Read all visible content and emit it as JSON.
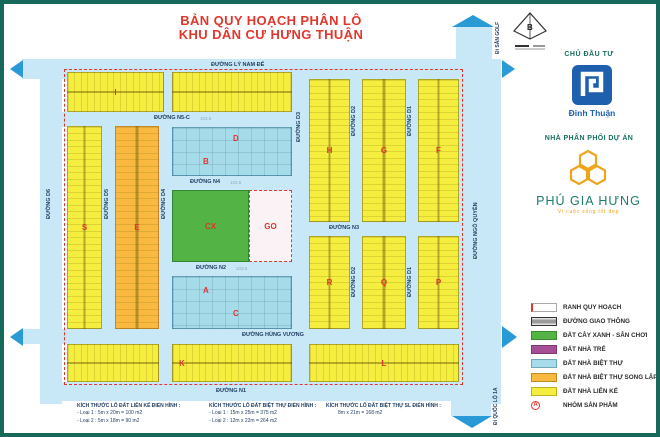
{
  "title": {
    "line1": "BẢN QUY HOẠCH PHÂN LÔ",
    "line2": "KHU DÂN CƯ HƯNG THUẬN"
  },
  "colors": {
    "frame": "#17695c",
    "title_red": "#e2372d",
    "road_blue": "#c9e8f7",
    "arrow_blue": "#2a9ad6",
    "lot_yellow": "#f6ee3f",
    "lot_orange": "#f9b940",
    "lot_cyan": "#a6dbea",
    "park_green": "#53b344",
    "nursery_purple": "#a64f97",
    "investor_blue": "#1e5fae",
    "brand_teal": "#1b7b6d",
    "brand_gold": "#f0a31c"
  },
  "sidebar": {
    "compass_label": "B",
    "investor_heading": "CHỦ ĐẦU TƯ",
    "investor_name": "Đinh Thuận",
    "distributor_heading": "NHÀ PHÂN PHỐI DỰ ÁN",
    "distributor_name": "PHÚ GIA HƯNG",
    "distributor_tagline": "Vì cuộc sống tốt đẹp"
  },
  "legend": {
    "items": [
      {
        "label": "RANH QUY HOẠCH",
        "type": "boundary"
      },
      {
        "label": "ĐƯỜNG GIAO THÔNG",
        "type": "road",
        "color": "#b9b9b9"
      },
      {
        "label": "ĐẤT CÂY XANH - SÂN CHƠI",
        "type": "fill",
        "color": "#53b344"
      },
      {
        "label": "ĐẤT NHÀ TRẺ",
        "type": "fill",
        "color": "#a64f97"
      },
      {
        "label": "ĐẤT NHÀ BIỆT THỰ",
        "type": "fill",
        "color": "#a6dbea"
      },
      {
        "label": "ĐẤT NHÀ BIỆT THỰ SONG LẬP",
        "type": "fill",
        "color": "#f9b940"
      },
      {
        "label": "ĐẤT NHÀ LIÊN KẾ",
        "type": "fill",
        "color": "#f6ee3f"
      },
      {
        "label": "NHÓM SẢN PHẨM",
        "type": "group",
        "symbol": "A"
      }
    ]
  },
  "map": {
    "roads": {
      "ly_nam_de": "ĐƯỜNG LÝ NAM ĐẾ",
      "ngo_quyen": "ĐƯỜNG NGÔ QUYỀN",
      "hung_vuong": "ĐƯỜNG HÙNG VƯƠNG",
      "n1": "ĐƯỜNG N1",
      "n2": "ĐƯỜNG N2",
      "n3": "ĐƯỜNG N3",
      "n4": "ĐƯỜNG N4",
      "n5c": "ĐƯỜNG N5-C",
      "d1": "ĐƯỜNG D1",
      "d2": "ĐƯỜNG D2",
      "d3": "ĐƯỜNG D3",
      "d4": "ĐƯỜNG D4",
      "d5": "ĐƯỜNG D5",
      "d6": "ĐƯỜNG D6"
    },
    "dims": {
      "n5c": "103.5",
      "n4": "103.5",
      "n2": "103.5"
    },
    "exits": {
      "golf": "Đi SÂN GOLF",
      "highway": "Đi QUỐC LỘ 1A"
    },
    "block_labels": {
      "I": "I",
      "S": "S",
      "E": "E",
      "B": "B",
      "D": "D",
      "CX": "CX",
      "GO": "GO",
      "A": "A",
      "C": "C",
      "H": "H",
      "G": "G",
      "F": "F",
      "R": "R",
      "Q": "Q",
      "P": "P",
      "K": "K",
      "L": "L"
    }
  },
  "notes": [
    {
      "title": "KÍCH THƯỚC LÔ ĐẤT LIÊN KẾ ĐIỂN HÌNH :",
      "lines": [
        "- Loại 1 :  5m x 20m = 100 m2",
        "- Loại 2 :  5m x 18m =  90 m2"
      ]
    },
    {
      "title": "KÍCH THƯỚC LÔ ĐẤT BIỆT THỰ ĐIỂN HÌNH :",
      "lines": [
        "- Loại 1 : 15m x 25m = 375 m2",
        "- Loại 2 : 12m x 22m = 264 m2"
      ]
    },
    {
      "title": "KÍCH THƯỚC LÔ ĐẤT BIỆT THỰ SL ĐIỂN HÌNH :",
      "lines": [
        "8m x 21m = 168 m2"
      ]
    }
  ]
}
